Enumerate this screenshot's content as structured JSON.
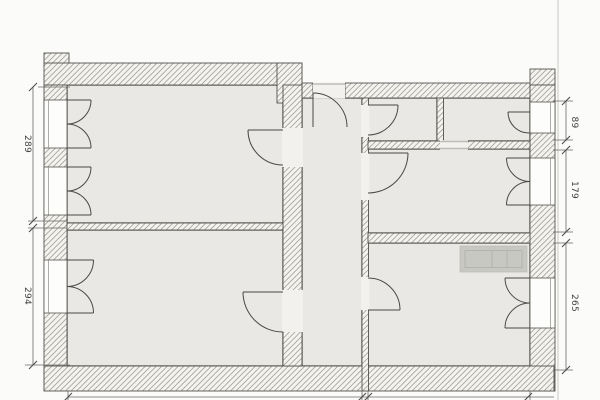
{
  "floorplan": {
    "dimension_labels": {
      "left_top": "289",
      "left_bottom": "294",
      "right_top": "89",
      "right_middle": "179",
      "right_bottom": "265"
    },
    "colors": {
      "paper": "#fbfbfa",
      "floor_fill": "#e9e8e4",
      "wall_hatch_line": "#a3a29b",
      "wall_outline": "#55534e",
      "room_outline": "#403f3b",
      "dimension_line": "#6a6864",
      "furniture_fill": "#c8c8c3",
      "furniture_inner": "#b0b0aa",
      "scan_edge": "#d2d2cd"
    }
  }
}
